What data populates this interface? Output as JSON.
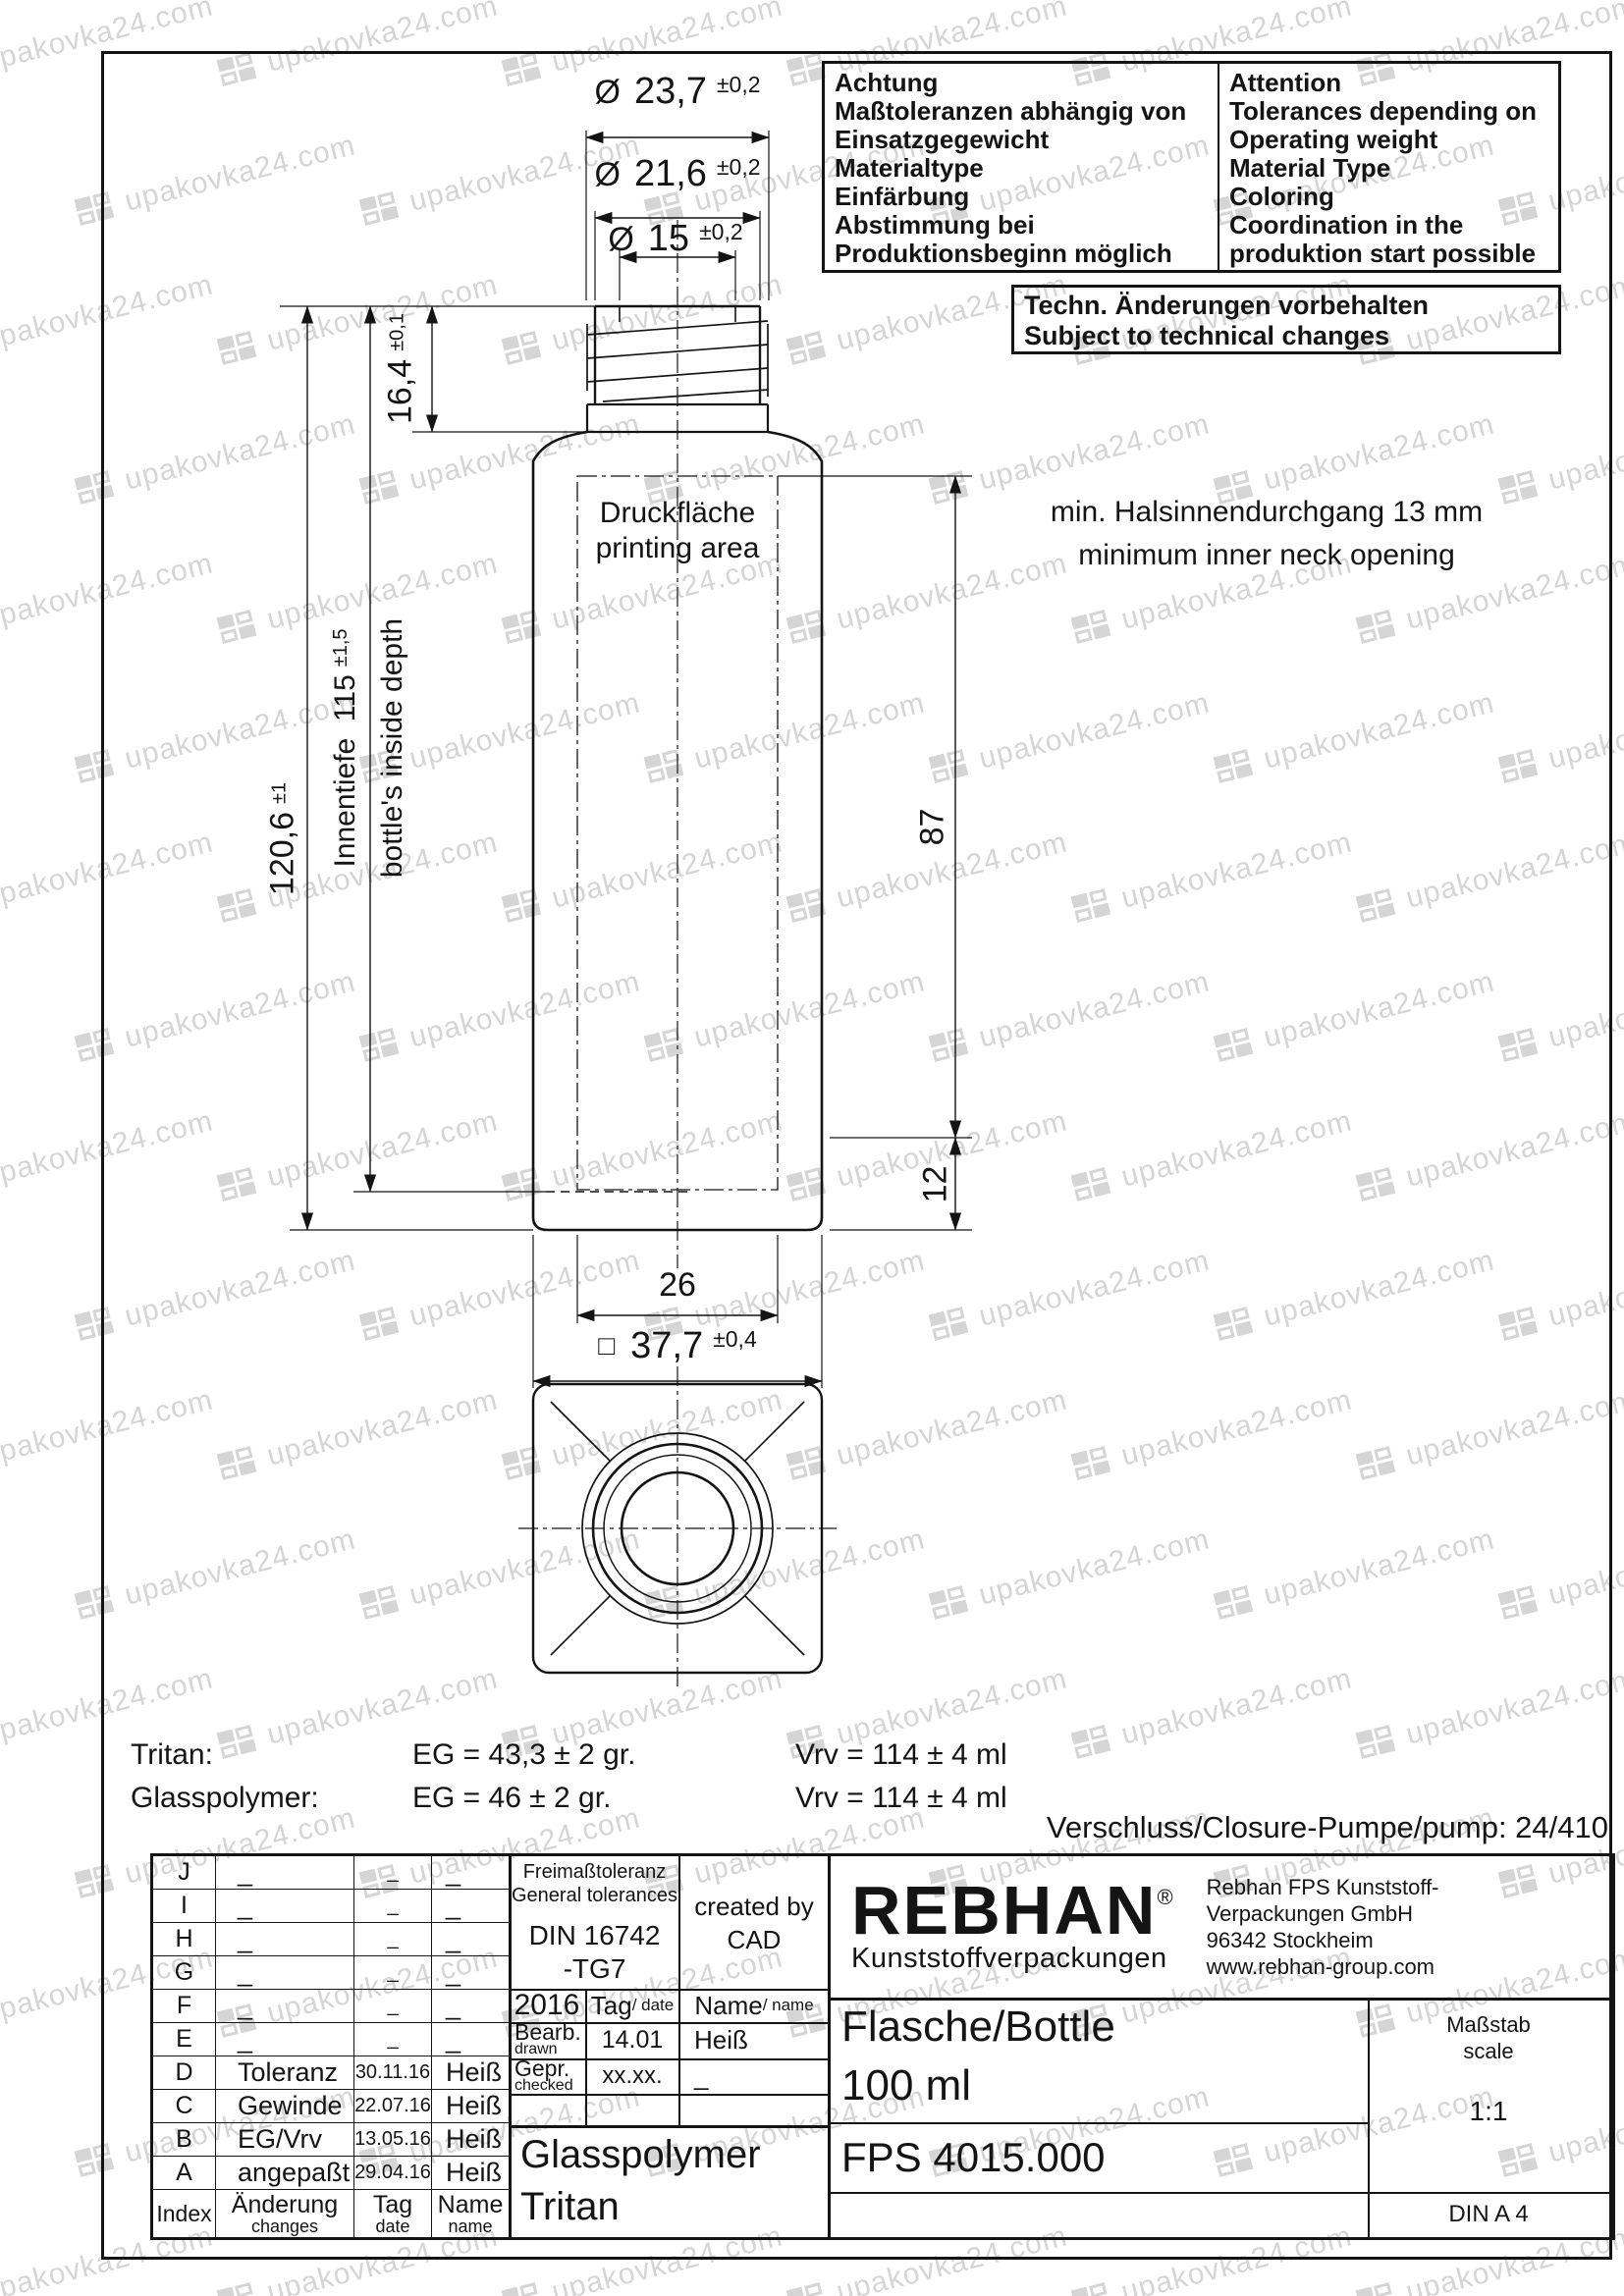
{
  "watermark": {
    "text": "upakovka24.com"
  },
  "attention_box": {
    "de": [
      "Achtung",
      "Maßtoleranzen abhängig von",
      "Einsatzgegewicht",
      "Materialtype",
      "Einfärbung",
      "Abstimmung bei",
      "Produktionsbeginn möglich"
    ],
    "en": [
      "Attention",
      "Tolerances depending on",
      "Operating weight",
      "Material Type",
      "Coloring",
      "Coordination in the",
      "produktion start possible"
    ]
  },
  "tech_changes_box": {
    "de": "Techn. Änderungen vorbehalten",
    "en": "Subject to technical changes"
  },
  "dimensions": {
    "dia_outer": {
      "symbol": "Ø",
      "value": "23,7",
      "tol": "±0,2"
    },
    "dia_mid": {
      "symbol": "Ø",
      "value": "21,6",
      "tol": "±0,2"
    },
    "dia_inner": {
      "symbol": "Ø",
      "value": "15",
      "tol": "±0,2"
    },
    "neck_height": {
      "value": "16,4",
      "tol": "±0,1"
    },
    "total_height": {
      "value": "120,6",
      "tol": "±1"
    },
    "inside_depth": {
      "label": "Innentiefe",
      "value": "115",
      "tol": "±1,5",
      "label_en": "bottle's inside depth"
    },
    "body_height": {
      "value": "87"
    },
    "base_height": {
      "value": "12"
    },
    "print_width": {
      "value": "26"
    },
    "body_width": {
      "symbol": "□",
      "value": "37,7",
      "tol": "±0,4"
    }
  },
  "notes": {
    "printing_area_de": "Druckfläche",
    "printing_area_en": "printing area",
    "neck_opening_de": "min. Halsinnendurchgang 13 mm",
    "neck_opening_en": "minimum inner neck opening",
    "closure": "Verschluss/Closure-Pumpe/pump: 24/410"
  },
  "weights": {
    "rows": [
      {
        "material": "Tritan:",
        "eg": "EG = 43,3 ± 2 gr.",
        "vrv": "Vrv = 114 ± 4 ml"
      },
      {
        "material": "Glasspolymer:",
        "eg": "EG = 46 ± 2 gr.",
        "vrv": "Vrv = 114 ± 4 ml"
      }
    ]
  },
  "revision_table": {
    "rows": [
      {
        "index": "J",
        "change": "_",
        "date": "_",
        "name": "_"
      },
      {
        "index": "I",
        "change": "_",
        "date": "_",
        "name": "_"
      },
      {
        "index": "H",
        "change": "_",
        "date": "_",
        "name": "_"
      },
      {
        "index": "G",
        "change": "_",
        "date": "_",
        "name": "_"
      },
      {
        "index": "F",
        "change": "_",
        "date": "_",
        "name": "_"
      },
      {
        "index": "E",
        "change": "_",
        "date": "_",
        "name": "_"
      },
      {
        "index": "D",
        "change": "Toleranz",
        "date": "30.11.16",
        "name": "Heiß"
      },
      {
        "index": "C",
        "change": "Gewinde",
        "date": "22.07.16",
        "name": "Heiß"
      },
      {
        "index": "B",
        "change": "EG/Vrv",
        "date": "13.05.16",
        "name": "Heiß"
      },
      {
        "index": "A",
        "change": "angepaßt",
        "date": "29.04.16",
        "name": "Heiß"
      }
    ],
    "footer": {
      "index": "Index",
      "change_de": "Änderung",
      "change_en": "changes",
      "date_de": "Tag",
      "date_en": "date",
      "name_de": "Name",
      "name_en": "name"
    }
  },
  "tolerance_box": {
    "de": "Freimaßtoleranz",
    "en": "General tolerances",
    "standard_line1": "DIN 16742",
    "standard_line2": "-TG7"
  },
  "created_by": {
    "line1": "created by",
    "line2": "CAD"
  },
  "approval": {
    "year": "2016",
    "date_label": "Tag",
    "date_label_en": "/ date",
    "name_label": "Name",
    "name_label_en": "/ name",
    "drawn_de": "Bearb.",
    "drawn_en": "drawn",
    "drawn_date": "14.01",
    "drawn_name": "Heiß",
    "checked_de": "Gepr.",
    "checked_en": "checked",
    "checked_date": "xx.xx.",
    "checked_name": "_"
  },
  "materials": {
    "line1": "Glasspolymer",
    "line2": "Tritan"
  },
  "company": {
    "logo": "REBHAN",
    "registered": "®",
    "subtitle": "Kunststoffverpackungen",
    "address": [
      "Rebhan FPS Kunststoff-",
      "Verpackungen GmbH",
      "96342 Stockheim",
      "www.rebhan-group.com"
    ]
  },
  "part": {
    "name_line1": "Flasche/Bottle",
    "name_line2": "100 ml",
    "number": "FPS 4015.000"
  },
  "scale": {
    "de": "Maßstab",
    "en": "scale",
    "value": "1:1"
  },
  "sheet": {
    "format": "DIN A 4"
  }
}
